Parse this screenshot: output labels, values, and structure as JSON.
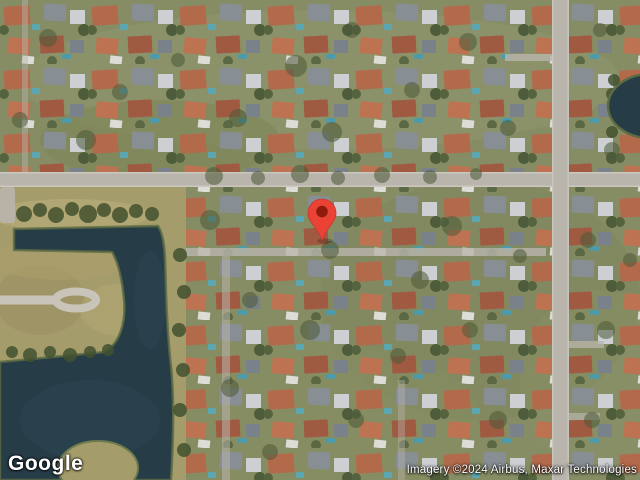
{
  "map": {
    "view": "satellite",
    "logo_text": "Google",
    "attribution_text": "Imagery ©2024 Airbus, Maxar Technologies",
    "marker": {
      "color": "#EA4335",
      "dot_color": "#8E1B0E"
    },
    "colors": {
      "vegetation": "#868c64",
      "field": "#a59c6c",
      "water": "#263c47",
      "road": "#b9b5ac"
    }
  }
}
